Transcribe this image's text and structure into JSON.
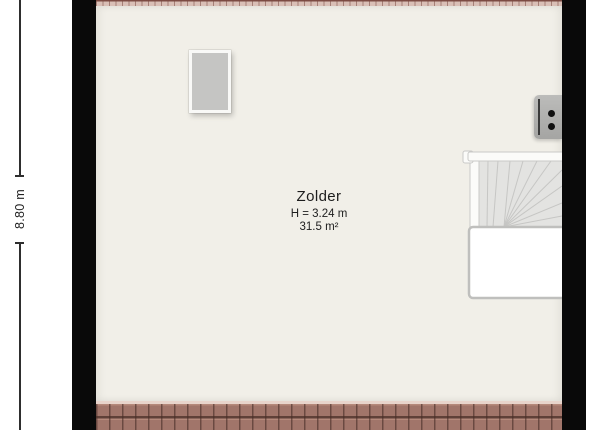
{
  "room": {
    "name": "Zolder",
    "ceiling_height": "H = 3.24 m",
    "area": "31.5 m²"
  },
  "dimension": {
    "label": "8.80 m"
  },
  "icons": {
    "skylight_window": "gray rectangle with white frame",
    "boiler_unit": "gray rounded box with two black dots",
    "staircase": "winder stairs fan with white stairwell void"
  },
  "colors": {
    "background": "#ffffff",
    "wall": "#090909",
    "floor": "#f1efe8",
    "roof_tiles": "#a1756a",
    "roof_tile_line": "#5f4038",
    "roof_ridge_highlight": "#e8d4cb",
    "roof_edge_top": "#7c4b43",
    "window_fill": "#c5c5c3",
    "window_frame": "#f9f9f7",
    "stair_fill": "#e3e3e1",
    "stair_line": "#c6c6c4",
    "stair_void_fill": "#ffffff",
    "stair_void_border": "#bfbfbd",
    "boiler_fill": "#b0b0ae",
    "text": "#1d1d1d"
  }
}
